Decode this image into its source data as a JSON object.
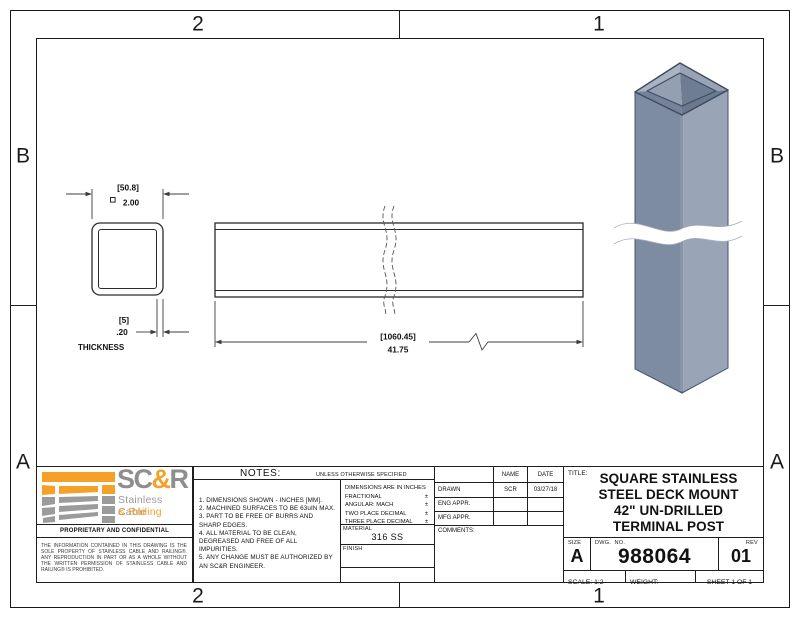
{
  "zones": {
    "top_left": "2",
    "top_right": "1",
    "bottom_left": "2",
    "bottom_right": "1",
    "left_top": "B",
    "left_bottom": "A",
    "right_top": "B",
    "right_bottom": "A"
  },
  "front_view": {
    "metric_width": "[50.8]",
    "inch_width": "2.00",
    "metric_thickness": "[5]",
    "inch_thickness": ".20",
    "thickness_label": "THICKNESS"
  },
  "side_view": {
    "metric_length": "[1060.45]",
    "inch_length": "41.75"
  },
  "logo": {
    "brand_sc": "SC",
    "brand_amp": "&",
    "brand_r": "R",
    "subtitle_line1": "Stainless Cable",
    "subtitle_line2": "& Railing",
    "confidential": "PROPRIETARY AND CONFIDENTIAL",
    "legal": "THE INFORMATION CONTAINED IN THIS DRAWING IS THE SOLE PROPERTY OF STAINLESS CABLE AND RAILING®. ANY REPRODUCTION IN PART OR AS A WHOLE WITHOUT THE WRITTEN PERMISSION OF STAINLESS CABLE AND RAILING® IS PROHIBITED.",
    "orange": "#F5A127",
    "gray": "#9B9B9B"
  },
  "notes": {
    "header": "NOTES:",
    "header_note": "UNLESS OTHERWISE SPECIFIED",
    "items": [
      "1. DIMENSIONS SHOWN - INCHES [MM].",
      "2. MACHINED SURFACES TO BE 63uIN MAX.",
      "3. PART TO BE FREE OF BURRS AND SHARP EDGES.",
      "4. ALL MATERIAL TO BE CLEAN, DEGREASED AND FREE OF ALL IMPURITIES.",
      "5. ANY CHANGE MUST BE AUTHORIZED BY AN SC&R ENGINEER."
    ]
  },
  "tolerances": {
    "line1": "DIMENSIONS ARE IN INCHES",
    "line2": "FRACTIONAL",
    "line3": "ANGULAR: MACH",
    "line4": "TWO PLACE DECIMAL",
    "line5": "THREE PLACE DECIMAL",
    "pm": "±"
  },
  "material": {
    "label": "MATERIAL",
    "value": "316 SS"
  },
  "finish": {
    "label": "FINISH",
    "value": ""
  },
  "approvals": {
    "name_header": "NAME",
    "date_header": "DATE",
    "drawn_label": "DRAWN",
    "drawn_name": "SCR",
    "drawn_date": "03/27/18",
    "eng_label": "ENG APPR.",
    "eng_name": "",
    "eng_date": "",
    "mfg_label": "MFG APPR.",
    "mfg_name": "",
    "mfg_date": "",
    "comments_label": "COMMENTS:"
  },
  "title_block": {
    "title_label": "TITLE:",
    "title_lines": [
      "SQUARE STAINLESS",
      "STEEL DECK MOUNT",
      "42\" UN-DRILLED",
      "TERMINAL POST"
    ],
    "size_label": "SIZE",
    "size": "A",
    "dwg_label": "DWG.  NO.",
    "dwg_no": "988064",
    "rev_label": "REV",
    "rev": "01",
    "scale": "SCALE: 1:2",
    "weight": "WEIGHT:",
    "sheet": "SHEET 1 OF 1"
  },
  "colors": {
    "accent_orange": "#F5A127",
    "logo_gray": "#9B9B9B",
    "post_left_face": "#7E8CA1",
    "post_right_face": "#99A5B7",
    "post_edge": "#46526B"
  }
}
